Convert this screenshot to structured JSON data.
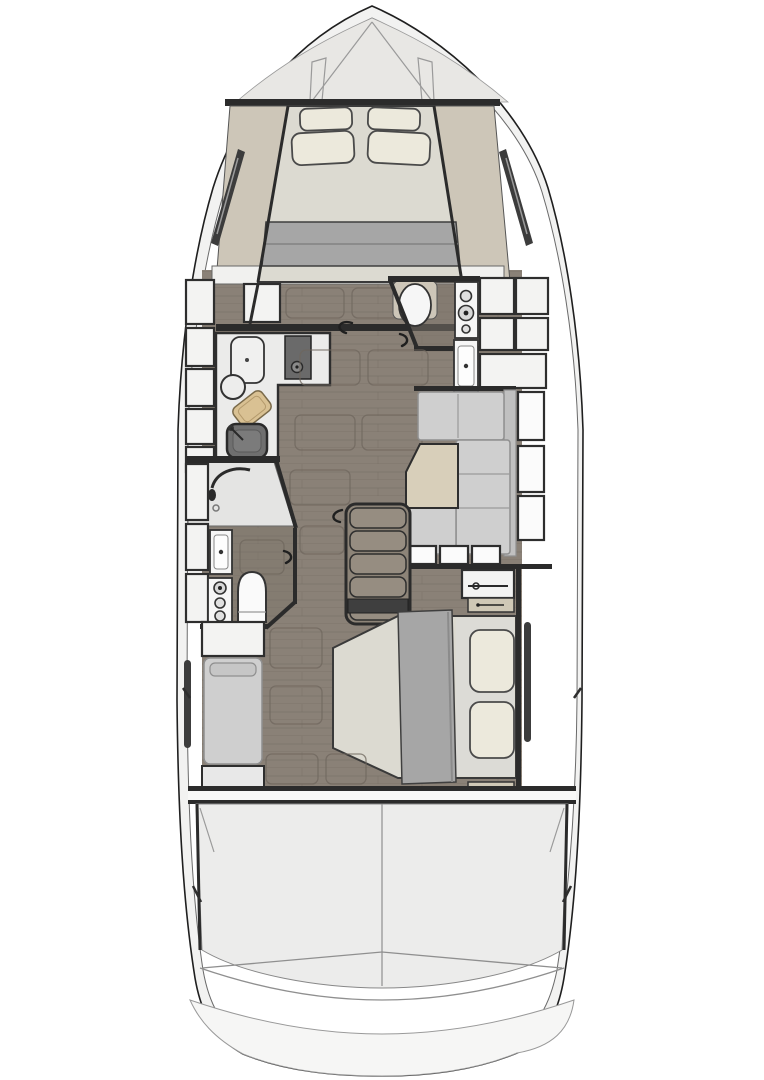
{
  "scene": {
    "type": "yacht-lower-deck-floor-plan",
    "orientation": "bow-up",
    "visible_text": [],
    "rooms": [
      {
        "name": "foredeck",
        "items": [
          "deck-seams",
          "hatch-outlines"
        ]
      },
      {
        "name": "forward-cabin",
        "items": [
          "v-berth-bed",
          "pillows",
          "folded-blanket",
          "side-shelves",
          "hull-window-slits",
          "floor-hatches",
          "sliding-door"
        ]
      },
      {
        "name": "forward-head",
        "items": [
          "toilet",
          "vanity-sink",
          "shower-controls",
          "storage-lockers"
        ]
      },
      {
        "name": "galley",
        "items": [
          "cooktop",
          "counter-lid",
          "round-sink",
          "cutting-board",
          "square-sink",
          "locker-column"
        ]
      },
      {
        "name": "salon-dinette",
        "items": [
          "l-shaped-sofa",
          "trapezoid-table",
          "hull-windows",
          "transom-windows"
        ]
      },
      {
        "name": "companionway-stairs",
        "items": [
          "treads",
          "handrail-hook"
        ]
      },
      {
        "name": "port-head",
        "items": [
          "shower",
          "vanity-sink",
          "controls",
          "toilet"
        ]
      },
      {
        "name": "master-cabin",
        "items": [
          "double-bed",
          "pillows",
          "blanket",
          "bench-sofa",
          "nightstands",
          "wardrobe-rod",
          "low-cabinet",
          "hull-window-slits",
          "floor-hatches",
          "drawers"
        ]
      },
      {
        "name": "aft-compartment",
        "items": [
          "garage-floor",
          "centerline-seam",
          "corner-braces",
          "swim-platform"
        ]
      }
    ],
    "counts": {
      "forward_pillows": 4,
      "master_pillows": 2,
      "stair_treads": 5,
      "dinette_hull_windows": 3,
      "transom_windows": 3,
      "galley_lockers": 5
    }
  },
  "colors": {
    "background": "#ffffff",
    "hull_fill": "#f2f2f1",
    "deck": "#e8e7e4",
    "bulkhead": "#2b2b2b",
    "frame_dark": "#2e2e2e",
    "wood_floor": "#8a8177",
    "wood_plank_line": "#6f675e",
    "wood_dark": "#7d756b",
    "cabinet_white": "#f3f3f2",
    "window_white": "#fbfbfb",
    "counter": "#ebebea",
    "stove": "#6a6a6a",
    "sink_dark": "#6f6f6f",
    "cutting_board": "#d9c193",
    "mattress": "#dcdad1",
    "pillow": "#ece9dc",
    "blanket": "#a6a6a6",
    "shelf_tan": "#cdc6b8",
    "sofa": "#cfcfcf",
    "table": "#d8cfba",
    "fixture_white": "#f6f6f6",
    "shower_floor": "#e4e4e3",
    "aft_floor": "#ececeb",
    "platform": "#f6f6f5",
    "nightstand": "#cfc8b6",
    "tv_dark": "#3f3f3f",
    "stair_tread": "#968d81"
  }
}
